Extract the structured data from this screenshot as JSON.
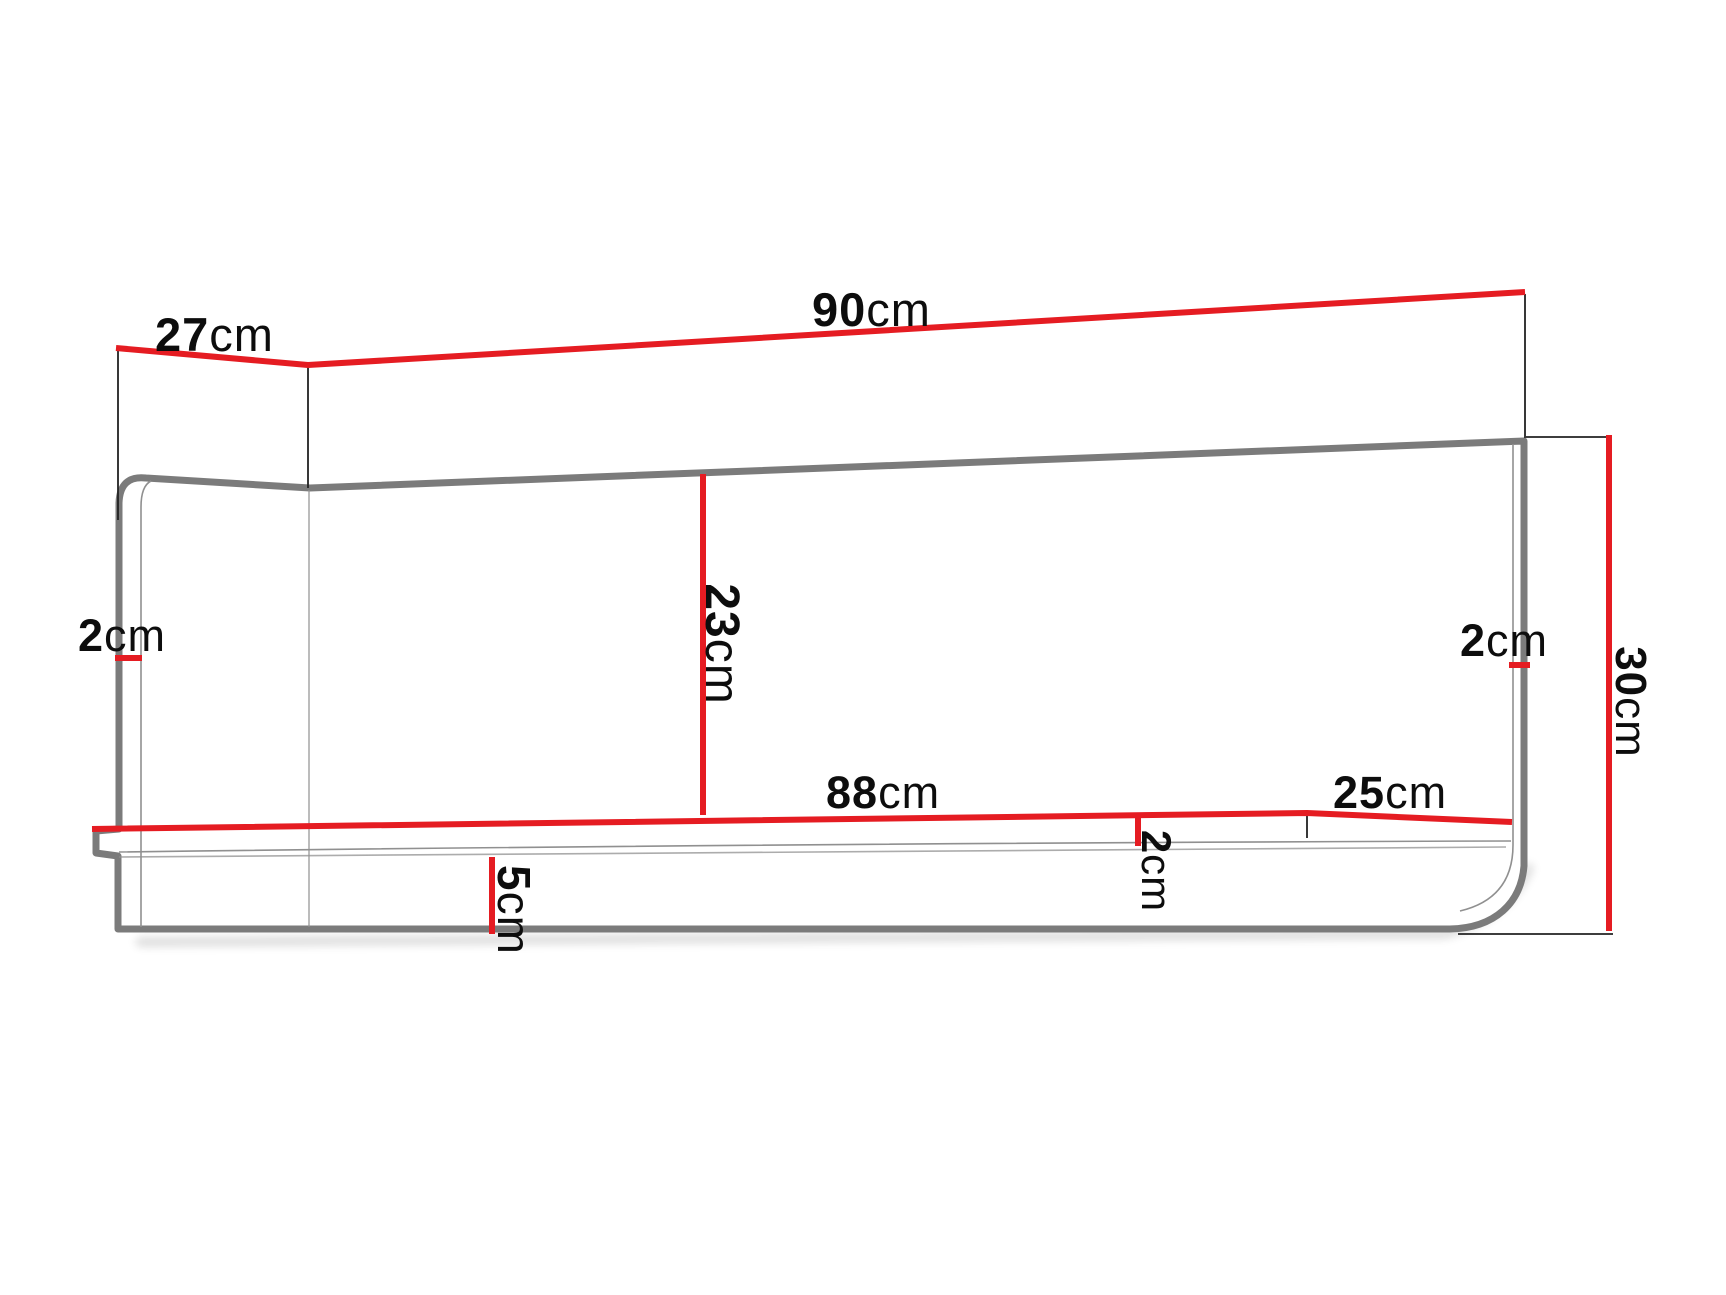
{
  "diagram": {
    "kind": "furniture-dimension-drawing",
    "colors": {
      "dimension_red": "#e51c22",
      "outline_gray": "#7b7b7b",
      "inner_line_gray": "#909090",
      "extension_black": "#222222",
      "label_black": "#0d0d0d",
      "background": "#ffffff"
    },
    "dimensions": {
      "depth_top": {
        "value": "27",
        "unit": "cm"
      },
      "width_top": {
        "value": "90",
        "unit": "cm"
      },
      "left_panel_thickness": {
        "value": "2",
        "unit": "cm"
      },
      "back_inner_height": {
        "value": "23",
        "unit": "cm"
      },
      "right_panel_thickness": {
        "value": "2",
        "unit": "cm"
      },
      "total_height": {
        "value": "30",
        "unit": "cm"
      },
      "shelf_width": {
        "value": "88",
        "unit": "cm"
      },
      "shelf_depth": {
        "value": "25",
        "unit": "cm"
      },
      "shelf_thickness": {
        "value": "2",
        "unit": "cm"
      },
      "front_rail_height": {
        "value": "5",
        "unit": "cm"
      }
    }
  }
}
